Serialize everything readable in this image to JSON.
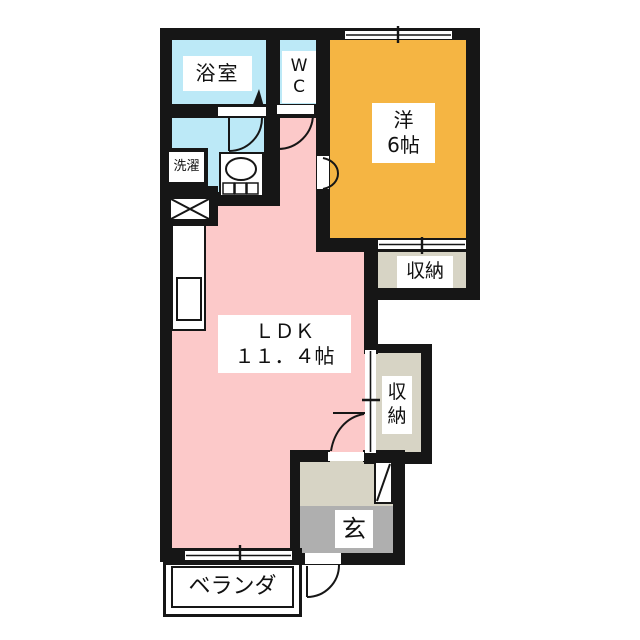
{
  "floorplan": {
    "rooms": {
      "bathroom": {
        "label": "浴室"
      },
      "wc": {
        "line1": "W",
        "line2": "C"
      },
      "laundry": {
        "label": "洗濯"
      },
      "western_room": {
        "line1": "洋",
        "line2": "6帖"
      },
      "storage_upper": {
        "label": "収納"
      },
      "storage_lower": {
        "line1": "収",
        "line2": "納"
      },
      "ldk": {
        "line1": "ＬＤＫ",
        "line2": "１１．４帖"
      },
      "entrance": {
        "label": "玄"
      },
      "veranda": {
        "label": "ベランダ"
      }
    },
    "colors": {
      "wall": "#161616",
      "ldk_pink": "#FCC9C9",
      "wet_cyan": "#BCE9F7",
      "western_orange": "#F5B543",
      "storage_beige": "#D7D4C5",
      "entrance_gray": "#AFAFAF"
    }
  }
}
